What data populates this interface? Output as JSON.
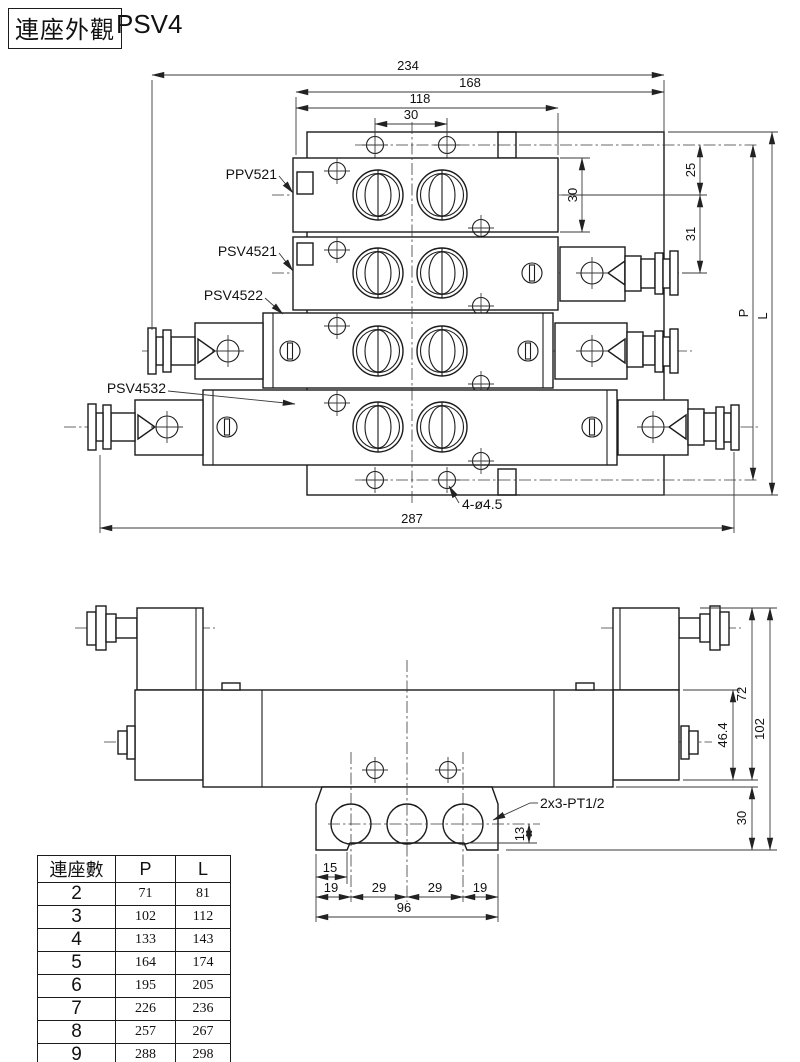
{
  "title": {
    "box_label": "連座外觀",
    "model": "PSV4"
  },
  "top_view": {
    "labels": {
      "ppv": "PPV521",
      "psv1": "PSV4521",
      "psv2": "PSV4522",
      "psv3": "PSV4532"
    },
    "dims": {
      "w234": "234",
      "w168": "168",
      "w118": "118",
      "w30": "30",
      "h30": "30",
      "h25": "25",
      "h31": "31",
      "p": "P",
      "l": "L",
      "w287": "287",
      "holes": "4-ø4.5"
    }
  },
  "front_view": {
    "dims": {
      "h72": "72",
      "h102": "102",
      "h46": "46.4",
      "h30": "30",
      "h13": "13",
      "w15": "15",
      "w19a": "19",
      "w29a": "29",
      "w29b": "29",
      "w19b": "19",
      "w96": "96",
      "ports": "2x3-PT1/2"
    }
  },
  "table": {
    "headers": [
      "連座數",
      "P",
      "L"
    ],
    "rows": [
      [
        "2",
        "71",
        "81"
      ],
      [
        "3",
        "102",
        "112"
      ],
      [
        "4",
        "133",
        "143"
      ],
      [
        "5",
        "164",
        "174"
      ],
      [
        "6",
        "195",
        "205"
      ],
      [
        "7",
        "226",
        "236"
      ],
      [
        "8",
        "257",
        "267"
      ],
      [
        "9",
        "288",
        "298"
      ],
      [
        "10",
        "319",
        "329"
      ]
    ]
  },
  "colors": {
    "line": "#1b1b1b",
    "background": "#ffffff"
  }
}
